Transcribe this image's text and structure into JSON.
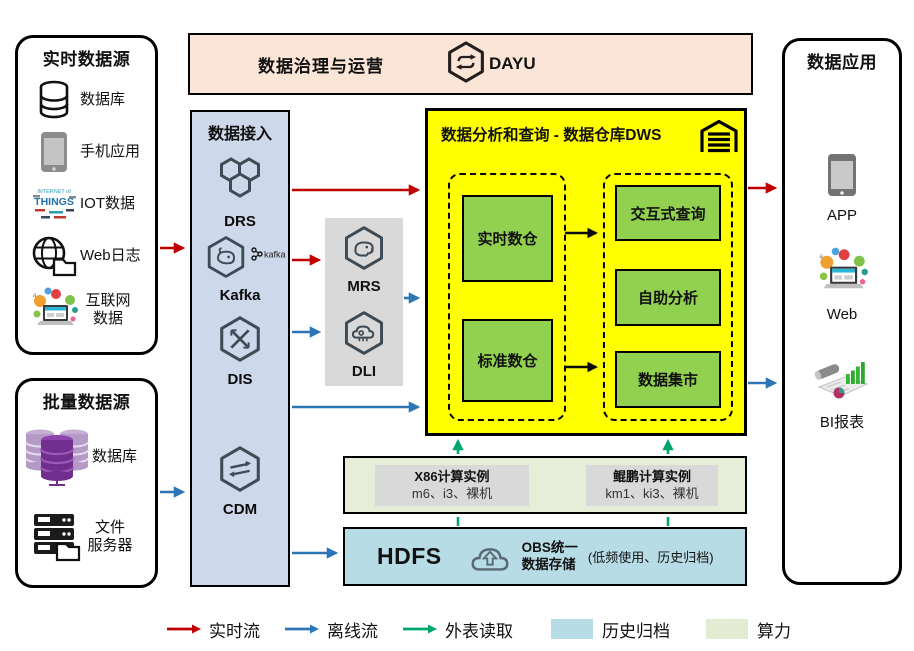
{
  "realtime_sources": {
    "title": "实时数据源",
    "items": [
      {
        "label": "数据库",
        "icon": "database-icon"
      },
      {
        "label": "手机应用",
        "icon": "mobile-phone-icon"
      },
      {
        "label": "IOT数据",
        "icon": "iot-wordcloud-icon",
        "icon_text_top": "INTERNET of",
        "icon_text_main": "THINGS"
      },
      {
        "label": "Web日志",
        "icon": "globe-folder-icon"
      },
      {
        "label_line1": "互联网",
        "label_line2": "数据",
        "icon": "internet-collage-icon"
      }
    ]
  },
  "batch_sources": {
    "title": "批量数据源",
    "items": [
      {
        "label": "数据库",
        "icon": "purple-database-icon"
      },
      {
        "label_line1": "文件",
        "label_line2": "服务器",
        "icon": "file-server-icon"
      }
    ]
  },
  "governance": {
    "title": "数据治理与运营",
    "product": "DAYU"
  },
  "access": {
    "title": "数据接入",
    "items": [
      {
        "label": "DRS"
      },
      {
        "label": "Kafka",
        "badge": "kafka"
      },
      {
        "label": "DIS"
      },
      {
        "label": "CDM"
      }
    ]
  },
  "processing": {
    "items": [
      {
        "label": "MRS"
      },
      {
        "label": "DLI"
      }
    ]
  },
  "dws": {
    "title": "数据分析和查询 - 数据仓库DWS",
    "warehouses": [
      {
        "label": "实时数仓"
      },
      {
        "label": "标准数仓"
      }
    ],
    "services": [
      {
        "label": "交互式查询"
      },
      {
        "label": "自助分析"
      },
      {
        "label": "数据集市"
      }
    ]
  },
  "compute": {
    "instances": [
      {
        "title": "X86计算实例",
        "specs": "m6、i3、裸机"
      },
      {
        "title": "鲲鹏计算实例",
        "specs": "km1、ki3、裸机"
      }
    ]
  },
  "storage": {
    "hdfs": "HDFS",
    "obs_line1": "OBS统一",
    "obs_line2": "数据存储",
    "note": "(低频使用、历史归档)"
  },
  "apps": {
    "title": "数据应用",
    "items": [
      {
        "label": "APP"
      },
      {
        "label": "Web"
      },
      {
        "label": "BI报表"
      }
    ]
  },
  "legend": {
    "flows": [
      {
        "label": "实时流",
        "color": "#c00000"
      },
      {
        "label": "离线流",
        "color": "#2e75b6"
      },
      {
        "label": "外表读取",
        "color": "#00a76d"
      }
    ],
    "swatches": [
      {
        "label": "历史归档",
        "color": "#b8dce6"
      },
      {
        "label": "算力",
        "color": "#e3ebd2"
      }
    ]
  },
  "colors": {
    "dws_bg": "#ffff00",
    "module_green": "#92d050",
    "governance_bg": "#fbe5d6",
    "access_bg": "#cdd9ea",
    "processing_bg": "#d9d9d9",
    "compute_bg": "#e6edd8",
    "storage_bg": "#b8dce6",
    "flow_red": "#c00000",
    "flow_blue": "#2e75b6",
    "flow_green": "#00a76d"
  }
}
